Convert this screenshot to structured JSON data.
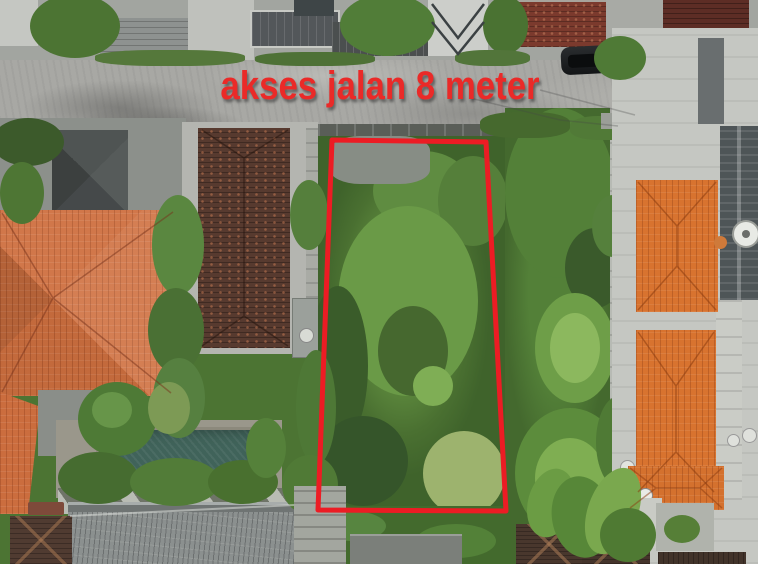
{
  "annotation": {
    "road_access_label": "akses jalan 8 meter",
    "label_color": "#ea2a28",
    "plot_outline_color": "#ec1c24"
  },
  "scene": {
    "type": "aerial-drone-photo",
    "subject": "overgrown vacant land plot outlined in red between villas, fronting an access road",
    "colors": {
      "vegetation": "#4c7433",
      "road_asphalt": "#a8a8a4",
      "left_roof_orange": "#cf7040",
      "right_roof_orange": "#d8732f",
      "house_roof_brown": "#573a2f",
      "pool_water": "#40635a",
      "concrete": "#c5c7c2"
    }
  }
}
